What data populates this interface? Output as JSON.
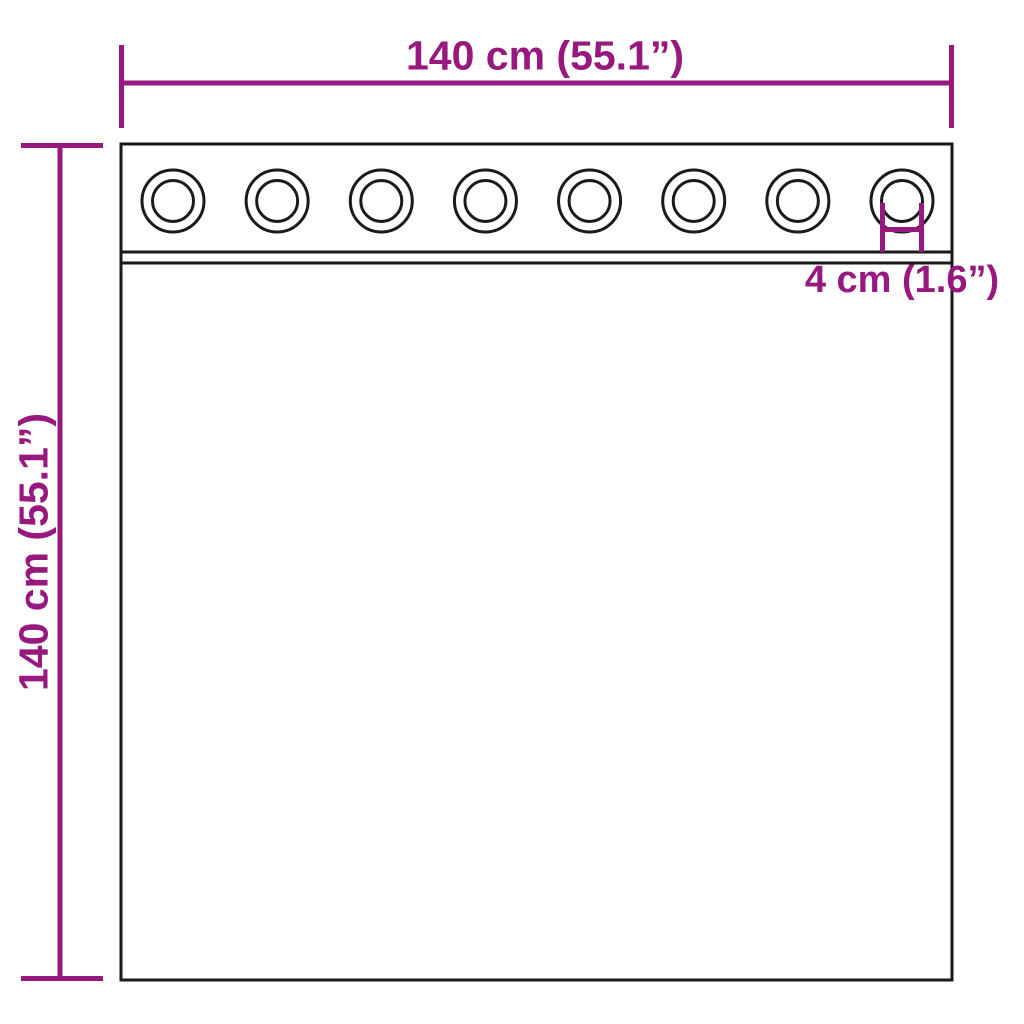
{
  "diagram": {
    "dimensions": {
      "width": {
        "label": "140 cm (55.1”)",
        "cm": 140,
        "inches": 55.1
      },
      "height": {
        "label": "140 cm (55.1”)",
        "cm": 140,
        "inches": 55.1
      },
      "grommet_hole": {
        "label": "4 cm (1.6”)",
        "cm": 4,
        "inches": 1.6
      }
    },
    "grommets": {
      "count": 8
    },
    "colors": {
      "accent_purple": "#97187f",
      "outline_black": "#1a1a1a",
      "background": "#ffffff"
    }
  }
}
